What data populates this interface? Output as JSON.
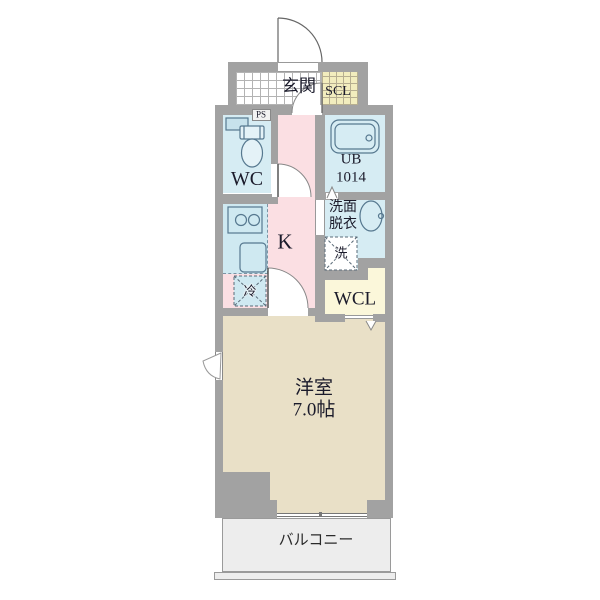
{
  "plan_title": "1K apartment floor plan",
  "rooms": {
    "genkan": {
      "label": "玄関"
    },
    "scl": {
      "label": "SCL"
    },
    "ps": {
      "label": "PS"
    },
    "wc": {
      "label": "WC"
    },
    "ub": {
      "label": "UB",
      "size_label": "1014"
    },
    "senmen": {
      "line1": "洗面",
      "line2": "脱衣"
    },
    "washer": {
      "label": "洗"
    },
    "kitchen": {
      "label": "K"
    },
    "fridge": {
      "label": "冷"
    },
    "wcl": {
      "label": "WCL"
    },
    "main_room": {
      "label": "洋室",
      "size_label": "7.0帖"
    },
    "balcony": {
      "label": "バルコニー"
    }
  },
  "colors": {
    "wall": "#a2a2a2",
    "hall_pink": "#fbdfe3",
    "wet_blue": "#d6ecf3",
    "room_beige": "#e9e0c7",
    "closet_yellow": "#fbf7da",
    "scl_yellow": "#f2edbe",
    "balcony_gray": "#ededed",
    "fixture_stroke": "#56788f",
    "text": "#1b1b2b"
  }
}
